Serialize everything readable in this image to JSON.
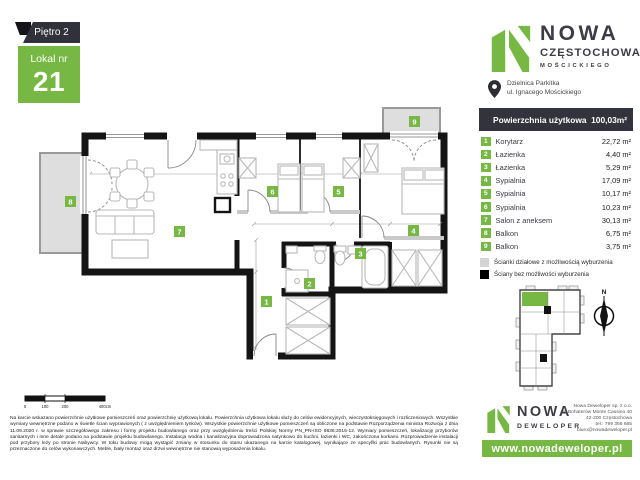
{
  "unit": {
    "floor": "Piętro 2",
    "lokal_label": "Lokal nr",
    "lokal_number": "21"
  },
  "brand": {
    "line1": "NOWA",
    "line2": "CZĘSTOCHOWA",
    "line3": "MOŚCICKIEGO"
  },
  "location": {
    "line1": "Dzielnica Parkitka",
    "line2": "ul. Ignacego Mościckiego"
  },
  "area_table": {
    "header_label": "Powierzchnia użytkowa",
    "header_value": "100,03m²",
    "rows": [
      {
        "num": "1",
        "name": "Korytarz",
        "area": "22,72 m²"
      },
      {
        "num": "2",
        "name": "Łazienka",
        "area": "4,40 m²"
      },
      {
        "num": "3",
        "name": "Łazienka",
        "area": "5,29 m²"
      },
      {
        "num": "4",
        "name": "Sypialnia",
        "area": "17,09 m²"
      },
      {
        "num": "5",
        "name": "Sypialnia",
        "area": "10,17 m²"
      },
      {
        "num": "6",
        "name": "Sypialnia",
        "area": "10,23 m²"
      },
      {
        "num": "7",
        "name": "Salon z aneksem",
        "area": "30,13 m²"
      },
      {
        "num": "8",
        "name": "Balkon",
        "area": "6,75 m²"
      },
      {
        "num": "9",
        "name": "Balkon",
        "area": "3,75 m²"
      }
    ]
  },
  "legend": {
    "partition_label": "Ścianki działowe z możliwością wyburzenia",
    "solid_label": "Ściany bez możliwości wyburzenia"
  },
  "plan": {
    "rooms": {
      "r1": "1",
      "r2": "2",
      "r3": "3",
      "r4": "4",
      "r5": "5",
      "r6": "6",
      "r7": "7",
      "r8": "8",
      "r9": "9"
    },
    "scale": {
      "t0": "0",
      "t100": "100",
      "t200": "200",
      "t400": "400cm"
    }
  },
  "site_plan": {
    "north": "N"
  },
  "disclaimer": "Na karcie wskazano powierzchnie użytkowe pomieszczeń oraz powierzchnię użytkową lokalu. Powierzchnia użytkowa lokalu służy do celów ewidencyjnych, wieczystoksięgowych i rozliczeniowych. Wszystkie wymiary wewnętrzne podano w świetle ścian wyprawionych ( z uwzględnieniem tynków). Wszystkie powierzchnie użytkowe pomieszczeń są obliczone na podstawie Rozporządzenia ministra Rozwoju z dnia 11.09.2020 r. w sprawie szczegółowego zakresu i formy projektu budowlanego oraz przy uwzględnieniu treści Polskiej Normy PN_PN-ISO 9836:2015-12. Wymiary pomieszczeń, lokalizację przyborów sanitarnych i inne detale podano na podstawie projektu budowlanego. Instalacja wodna i kanalizacyjna doprowadzona natynkowo do kuchni, łazienki i WC, zakończona korkami. Rozprowadzenie instalacji pod przybory leży po stronie Nabywcy. W toku budowy mogą wystąpić zmiany w stosunku do stanu ukazanego na karcie katalogowej, wynikające ze specyfiki prac budowlanych. Rysunki nie są przeznaczone do celów wykonawczych. Meble, biały montaż oraz drzwi wewnętrzne nie stanowią wyposażenia lokalu.",
  "footer": {
    "brand_line1": "NOWA",
    "brand_line2": "DEWELOPER",
    "company": [
      "Nowa Deweloper sp. z o.o.",
      "Al.Bohaterów Monte Cassino 40",
      "42-200 Częstochowa",
      "tel.: 799 366 665",
      "biuro@nowadeweloper.pl"
    ],
    "website": "www.nowadeweloper.pl"
  },
  "colors": {
    "green": "#76b843",
    "dark": "#33333d"
  }
}
